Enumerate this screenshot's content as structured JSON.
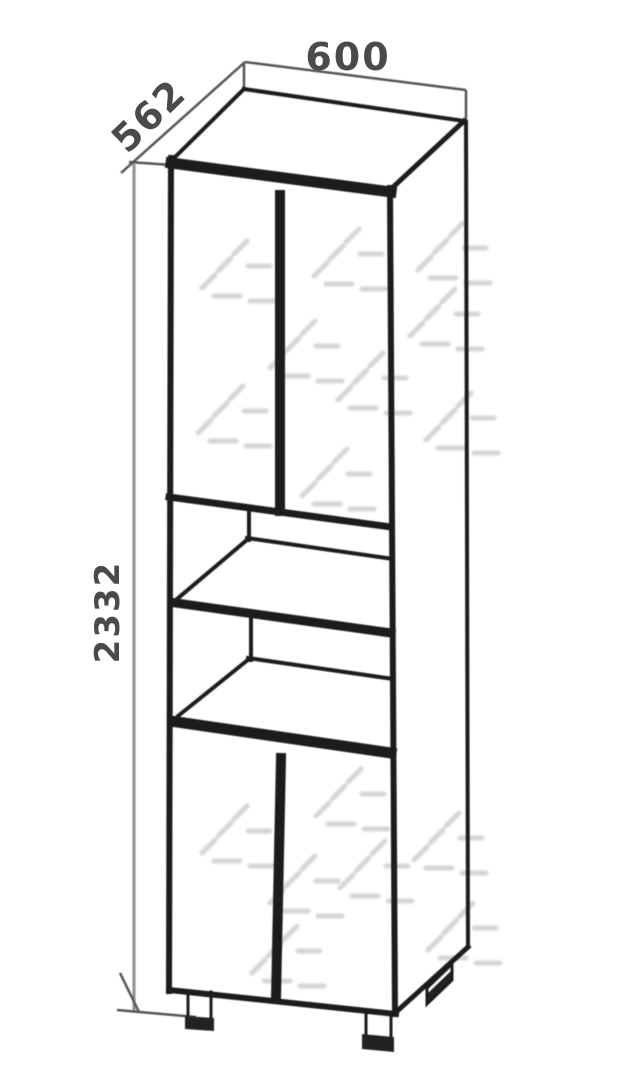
{
  "drawing": {
    "title": "cabinet-technical-drawing",
    "dimensions": {
      "width_mm": "600",
      "depth_mm": "562",
      "height_mm": "2332"
    },
    "colors": {
      "edge_line": "#1f1f1f",
      "dimension_line": "#555555",
      "height_dimension_line": "#8f8f8f",
      "label_text": "#4a4a4a",
      "watermark": "#9b9b9b",
      "background": "#ffffff"
    }
  }
}
